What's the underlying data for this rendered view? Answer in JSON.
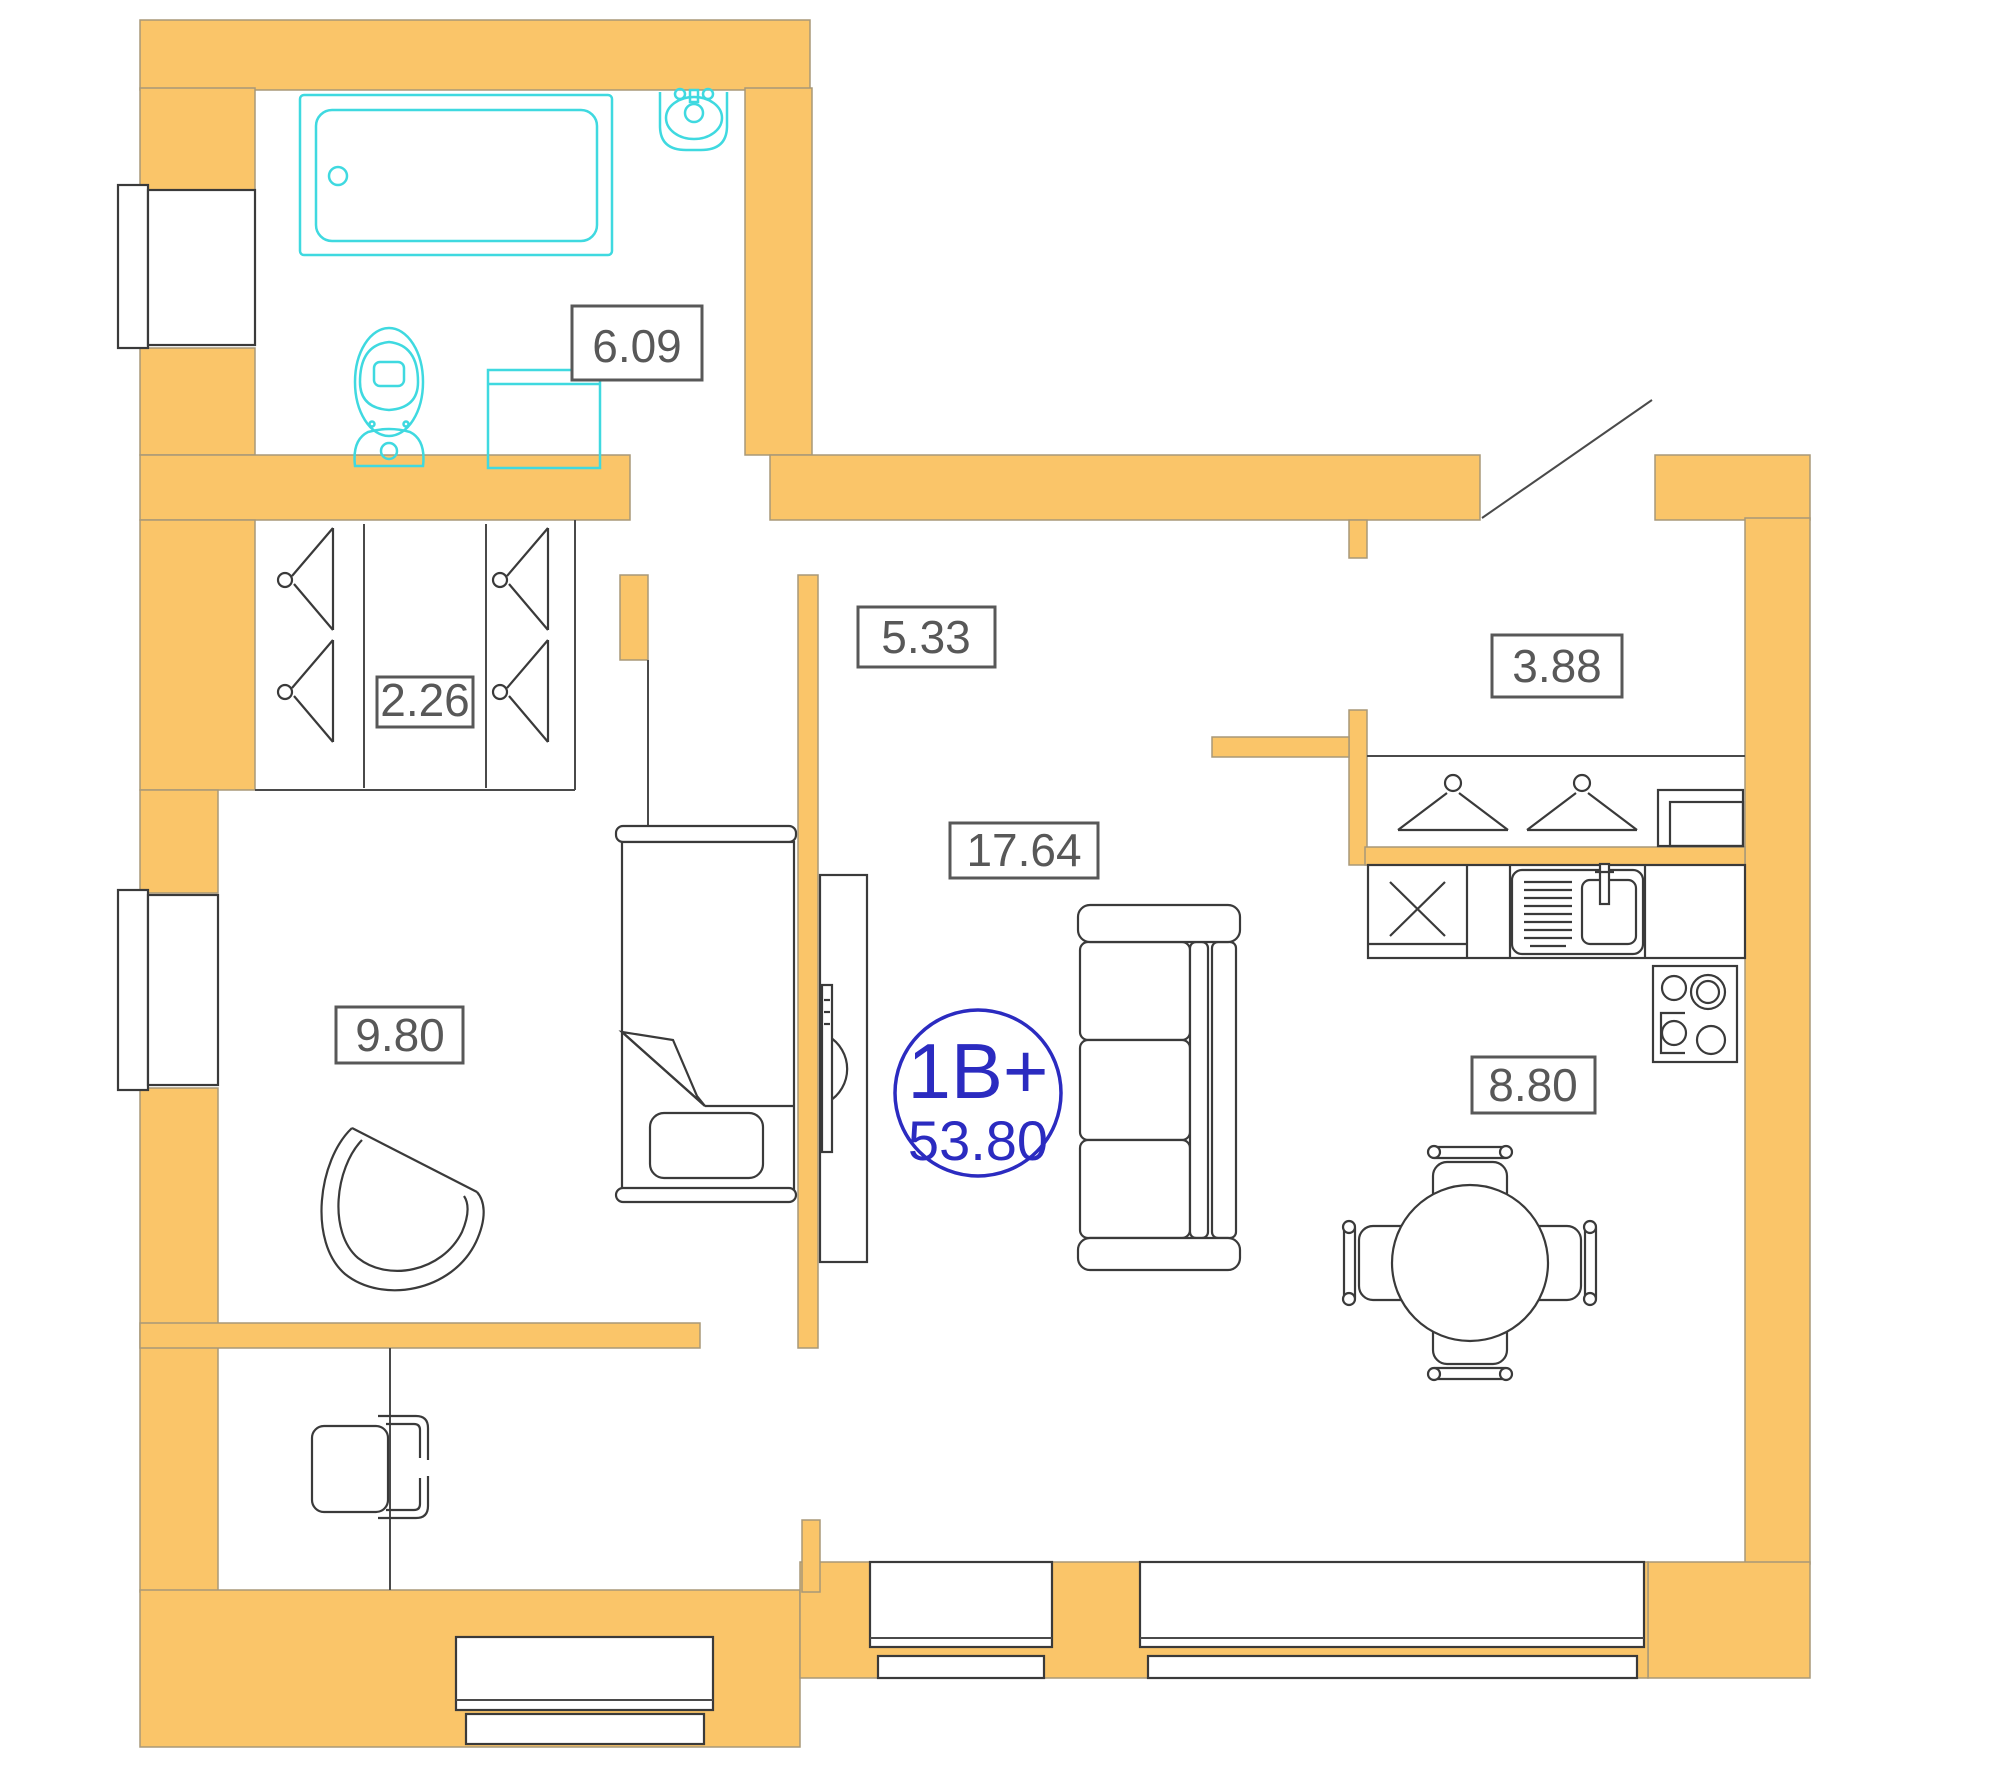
{
  "plan_title": "apartment-floor-plan",
  "rooms": {
    "bathroom": {
      "area": "6.09"
    },
    "wardrobe": {
      "area": "2.26"
    },
    "hallway": {
      "area": "5.33"
    },
    "entry": {
      "area": "3.88"
    },
    "bedroom": {
      "area": "9.80"
    },
    "living_room": {
      "area": "17.64"
    },
    "kitchen": {
      "area": "8.80"
    }
  },
  "unit_badge": {
    "type": "1B+",
    "total_area": "53.80"
  },
  "colors": {
    "wall_fill": "#FAC569",
    "wall_outline": "#A89878",
    "fixture_cyan": "#3FD9E0",
    "furniture_line": "#3a3a3a",
    "label_gray": "#585858",
    "badge_blue": "#2B2BC0",
    "background": "#ffffff"
  },
  "icons": [
    "bathtub-icon",
    "wash-basin-icon",
    "toilet-icon",
    "washing-machine-icon",
    "hanger-icon",
    "shoe-cabinet-icon",
    "kitchen-counter-icon",
    "kitchen-sink-icon",
    "stove-icon",
    "dining-table-icon",
    "dining-chair-icon",
    "sofa-icon",
    "tv-icon",
    "bed-icon",
    "armchair-icon",
    "desk-chair-icon",
    "window-icon",
    "entrance-door-icon"
  ]
}
